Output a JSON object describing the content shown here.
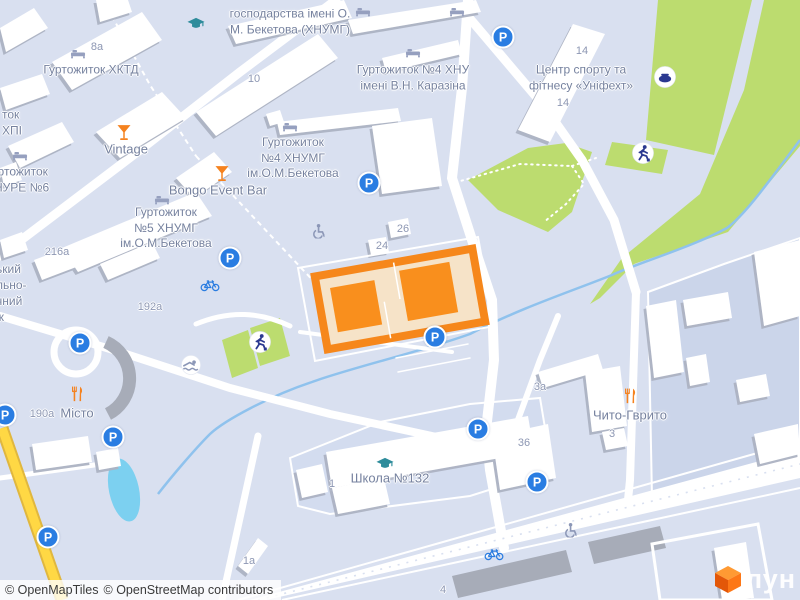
{
  "map": {
    "colors": {
      "highlight_orange": "#F6871B",
      "highlight_fill": "#F6E3C8",
      "parking_blue": "#2A7DE2",
      "green": "#BCDC6F",
      "water": "#7CD0F0",
      "road_yellow": "#FFD844"
    },
    "glyphs": {
      "parking": "P"
    },
    "labels": {
      "hosp": [
        "господарства імені О.",
        "М. Бекетова (ХНУМГ)"
      ],
      "hktd": "Гуртожиток ХКТД",
      "hpi": [
        "ток",
        "ХПІ"
      ],
      "hnure": [
        "Гуртожиток",
        "ХНУРЕ №6"
      ],
      "hnu4": [
        "Гуртожиток №4 ХНУ",
        "імені В.Н. Каразіна"
      ],
      "unifeht": [
        "Центр спорту та",
        "фітнесу «Уніфехт»"
      ],
      "hnumg4": [
        "Гуртожиток",
        "№4 ХНУМГ",
        "ім.О.М.Бекетова"
      ],
      "hnumg5": [
        "Гуртожиток",
        "№5 ХНУМГ",
        "ім.О.М.Бекетова"
      ],
      "vintage": "Vintage",
      "bongo": "Bongo Event Bar",
      "misto": "Місто",
      "chyto": "Чито-Гврито",
      "school": "Школа №132",
      "left_fragment": [
        "ький",
        "льно-",
        "чний",
        "ж"
      ]
    },
    "house_numbers": {
      "n8a": "8а",
      "n10": "10",
      "n14a": "14",
      "n14b": "14",
      "n216a": "216а",
      "n192a": "192а",
      "n190a": "190а",
      "n24": "24",
      "n26": "26",
      "n1": "1",
      "n1a": "1а",
      "n3a": "3а",
      "n3": "3",
      "n36": "36",
      "n4": "4"
    },
    "attribution": {
      "part1": "© OpenMapTiles",
      "part2": "© OpenStreetMap contributors"
    },
    "logo": {
      "text": "лун"
    }
  }
}
